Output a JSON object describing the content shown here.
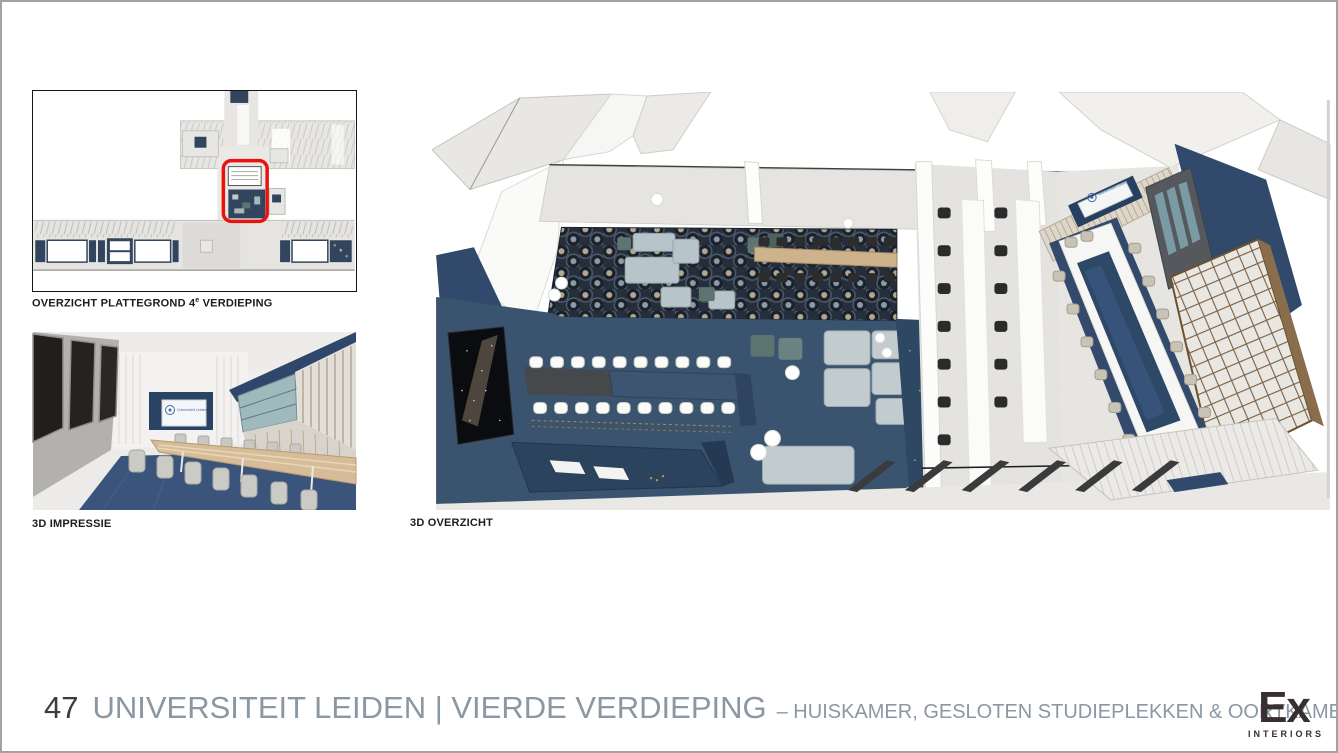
{
  "page": {
    "number": "47",
    "title": "UNIVERSITEIT LEIDEN | VIERDE VERDIEPING",
    "subtitle": "– HUISKAMER, GESLOTEN STUDIEPLEKKEN & OORTKAMER"
  },
  "captions": {
    "floorplan_prefix": "OVERZICHT PLATTEGROND 4",
    "floorplan_sup": "e",
    "floorplan_suffix": " VERDIEPING",
    "impression": "3D IMPRESSIE",
    "overview": "3D OVERZICHT"
  },
  "logos": {
    "ex_name": "Ex",
    "ex_subtext": "INTERIORS",
    "universiteit_leiden": "Universiteit Leiden"
  },
  "colors": {
    "highlight_red": "#e8130d",
    "navy_wall": "#31496b",
    "navy_floor": "#3a546f",
    "carpet_dark": "#252e3a",
    "wood": "#cdb28c",
    "sofa_blue": "#b7c4ca",
    "pouf_teal": "#5d7470",
    "chair_black": "#2c2c2c",
    "chair_beige": "#c8c3b5",
    "floor_gray": "#e5e4e0",
    "title_gray": "#8b97a2",
    "logo_dark": "#382f30"
  }
}
